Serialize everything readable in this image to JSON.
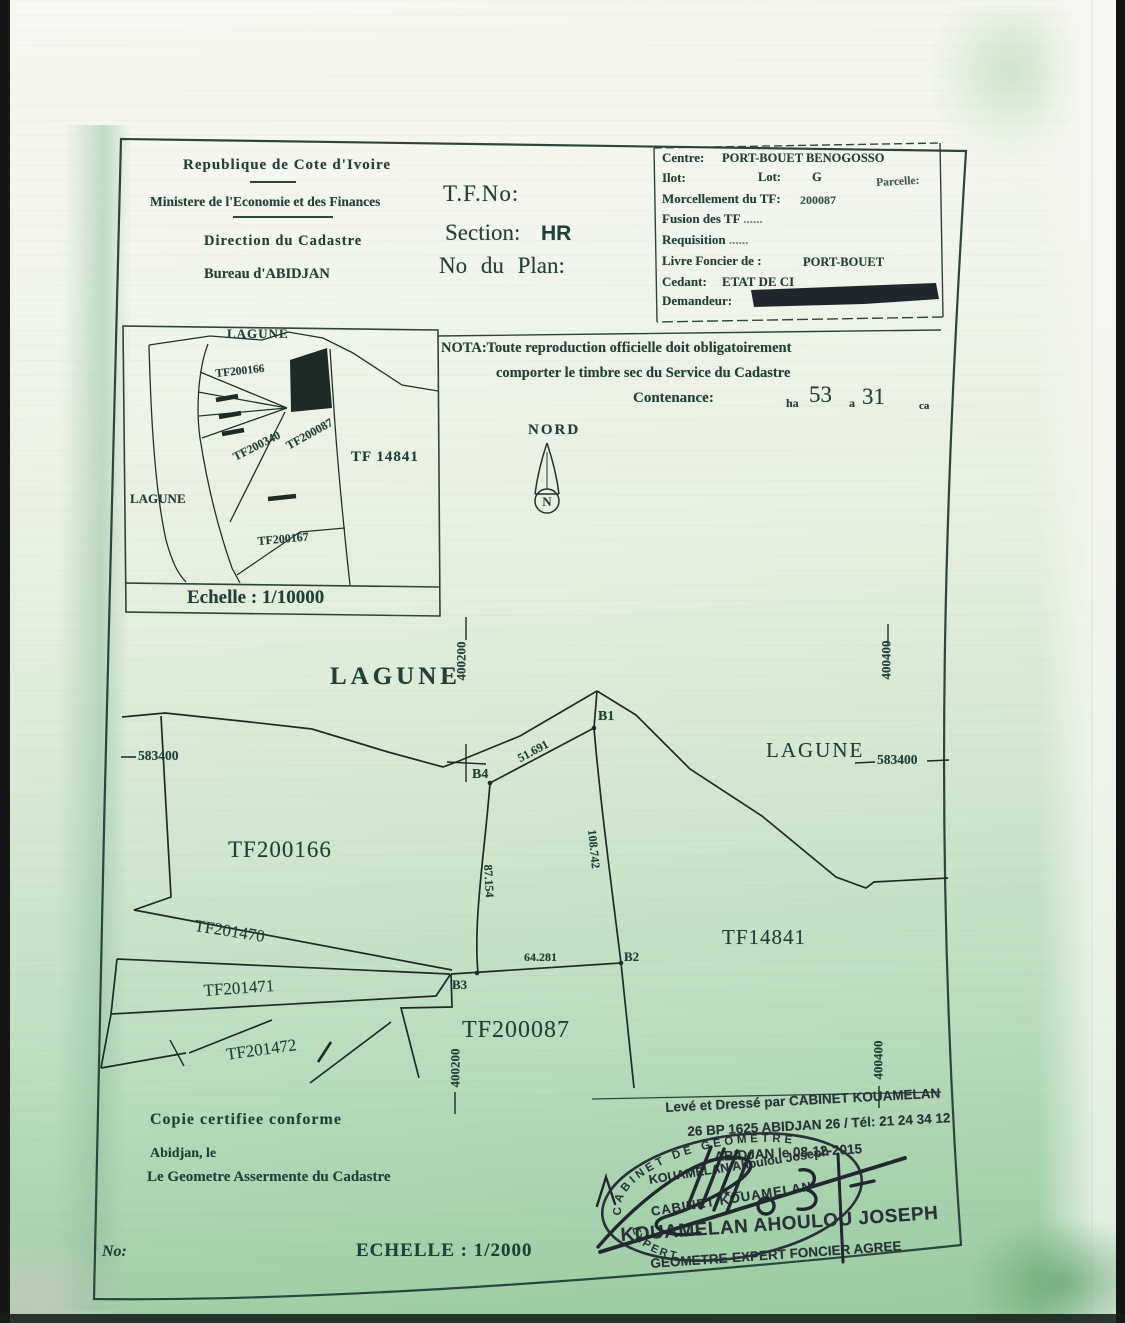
{
  "colors": {
    "ink": "#21403a",
    "map_line": "#1f2b28",
    "stamp_ink": "#2a3138",
    "paper_green": "#a7d2b2"
  },
  "header": {
    "republic": "Republique de Cote d'Ivoire",
    "ministry": "Ministere de l'Economie et des Finances",
    "tf_no_label": "T.F.No:",
    "direction": "Direction du Cadastre",
    "section_label": "Section:",
    "section_value": "HR",
    "bureau": "Bureau d'ABIDJAN",
    "plan_label": "No du Plan:"
  },
  "info_box": {
    "centre_label": "Centre:",
    "centre_value": "PORT-BOUET BENOGOSSO",
    "ilot_label": "Ilot:",
    "lot_label": "Lot:",
    "lot_value": "G",
    "parcelle_label": "Parcelle:",
    "morcellement_label": "Morcellement du TF:",
    "morcellement_value": "200087",
    "fusion_label": "Fusion des TF",
    "fusion_dots": "......",
    "requisition_label": "Requisition",
    "requisition_dots": "......",
    "livre_label": "Livre Foncier de :",
    "livre_value": "PORT-BOUET",
    "cedant_label": "Cedant:",
    "cedant_value": "ETAT DE CI",
    "demandeur_label": "Demandeur:"
  },
  "nota_box": {
    "line1": "NOTA:Toute reproduction officielle doit obligatoirement",
    "line2": "comporter le timbre sec du Service du Cadastre",
    "contenance_label": "Contenance:",
    "ha_unit": "ha",
    "ha_value": "53",
    "a_unit": "a",
    "a_value": "31",
    "ca_unit": "ca"
  },
  "compass": {
    "label": "NORD",
    "letter": "N"
  },
  "inset_map": {
    "lagune_top": "LAGUNE",
    "lagune_left": "LAGUNE",
    "parcel_tf200166": "TF200166",
    "parcel_tf200340": "TF200340",
    "parcel_tf200087": "TF200087",
    "parcel_tf14841": "TF 14841",
    "parcel_tf200167": "TF200167",
    "scale": "Echelle : 1/10000"
  },
  "main_map": {
    "lagune_top": "LAGUNE",
    "lagune_right": "LAGUNE",
    "coord_top_left": "400200",
    "coord_top_right": "400400",
    "coord_left": "583400",
    "coord_right": "583400",
    "coord_bottom_left": "400200",
    "coord_bottom_right": "400400",
    "parcel_tf200166": "TF200166",
    "parcel_tf201470": "TF201470",
    "parcel_tf201471": "TF201471",
    "parcel_tf201472": "TF201472",
    "parcel_tf200087": "TF200087",
    "parcel_tf14841": "TF14841",
    "point_b1": "B1",
    "point_b2": "B2",
    "point_b3": "B3",
    "point_b4": "B4",
    "dist_b4_b1": "51.691",
    "dist_b1_b2": "108.742",
    "dist_b4_b3": "87.154",
    "dist_b3_b2": "64.281"
  },
  "certification": {
    "copy": "Copie certifiee conforme",
    "place_date": "Abidjan, le",
    "signatory": "Le Geometre Assermente du Cadastre",
    "no_label": "No:",
    "scale": "ECHELLE : 1/2000"
  },
  "surveyor_block": {
    "line1": "Levé et Dressé par CABINET KOUAMELAN",
    "line2": "26 BP 1625 ABIDJAN 26 / Tél: 21 24 34 12",
    "line3": "ABIDJAN le 08-12-2015",
    "stamp_arc_top": "CABINET DE GEOMETRE",
    "stamp_name": "KOUAMELAN Ahoulou Joseph",
    "stamp_divider": "—★—",
    "stamp_cabinet": "CABINET KOUAMELAN",
    "stamp_arc_bottom": "EXPERT",
    "surveyor_name": "KOUAMELAN AHOULOU JOSEPH",
    "surveyor_title": "GEOMETRE-EXPERT FONCIER AGREE"
  }
}
